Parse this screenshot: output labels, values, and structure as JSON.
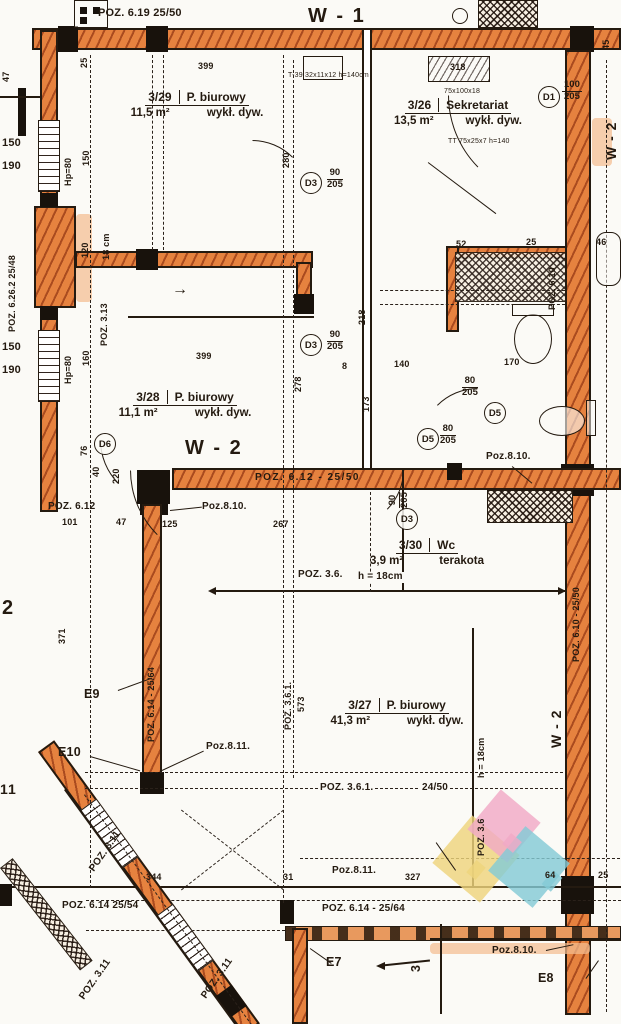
{
  "colors": {
    "wall_orange": "#e6823f",
    "wall_halo": "#f4bd90",
    "ink": "#241a10",
    "paper": "#fbfaf6",
    "logo_yellow": "#eed47c",
    "logo_pink": "#f0a9c6",
    "logo_teal": "#84cbd5"
  },
  "axes": {
    "w1": "W - 1",
    "w2_top_right": "W - 2",
    "w2_center": "W - 2",
    "w2_bottom_right": "W - 2",
    "axis_2": "2",
    "axis_11": "11",
    "section_3": "3"
  },
  "rooms": {
    "r329": {
      "num": "3/29",
      "name": "P. biurowy",
      "area": "11,5 m²",
      "finish": "wykł. dyw."
    },
    "r326": {
      "num": "3/26",
      "name": "Sekretariat",
      "area": "13,5 m²",
      "finish": "wykł. dyw."
    },
    "r328": {
      "num": "3/28",
      "name": "P. biurowy",
      "area": "11,1 m²",
      "finish": "wykł. dyw."
    },
    "r330": {
      "num": "3/30",
      "name": "Wc",
      "area": "3,9 m²",
      "finish": "terakota"
    },
    "r327": {
      "num": "3/27",
      "name": "P. biurowy",
      "area": "41,3 m²",
      "finish": "wykł. dyw."
    }
  },
  "poz": {
    "p619": "POZ. 6.19 25/50",
    "p6262": "POZ. 6.26.2 25/48",
    "p313": "POZ. 3.13",
    "p612_wall": "POZ. 6.12 - 25/50",
    "p612": "POZ. 6.12",
    "p810_a": "Poz.8.10.",
    "p810_b": "Poz.8.10.",
    "p810_c": "Poz.8.10.",
    "p811_a": "Poz.8.11.",
    "p811_b": "Poz.8.11.",
    "p36": "POZ. 3.6.",
    "p36_axis": "POZ. 3.6",
    "p361_v": "POZ. 3.6.1.",
    "p361": "POZ. 3.6.1.",
    "p361_size": "24/50",
    "p311_a": "POZ. 3.11",
    "p311_b": "POZ. 3.11",
    "p311_c": "POZ. 3.11",
    "p614_left": "POZ. 6.14 25/54",
    "p614_bottom": "POZ. 6.14 - 25/64",
    "p614_wall": "POZ. 6.14 - 25/64",
    "p610_top": "POZ. 6.10",
    "p610_right": "POZ. 6.10 - 25/50"
  },
  "exits": {
    "e7": "E7",
    "e8": "E8",
    "e9": "E9",
    "e10": "E10"
  },
  "doors": {
    "d1": {
      "tag": "D1",
      "w": "100",
      "h": "205"
    },
    "d3a": {
      "tag": "D3",
      "w": "90",
      "h": "205"
    },
    "d3b": {
      "tag": "D3",
      "w": "90",
      "h": "205"
    },
    "d3c": {
      "tag": "D3",
      "w": "90",
      "h": "205"
    },
    "d5a": {
      "tag": "D5",
      "w": "80",
      "h": "205"
    },
    "d5b": {
      "tag": "D5",
      "w": "80",
      "h": "205"
    },
    "d6": {
      "tag": "D6"
    }
  },
  "dims": {
    "v399a": "399",
    "v399b": "399",
    "v318": "318",
    "v280": "280",
    "v218": "218",
    "v278": "278",
    "v8": "8",
    "v140": "140",
    "v170": "170",
    "v120": "120",
    "v18cm": "18 cm",
    "v173": "173",
    "v101": "101",
    "v47": "47",
    "v47b": "47",
    "v125": "125",
    "v267": "267",
    "v371": "371",
    "v344": "344",
    "v31": "31",
    "v327": "327",
    "v64": "64",
    "v25a": "25",
    "v25b": "25",
    "v25c": "25",
    "v45": "45",
    "v52": "52",
    "v46": "46",
    "v573": "573",
    "v150a": "150",
    "v190a": "190",
    "v150r": "150",
    "v150b": "150",
    "v190b": "190",
    "v160": "160",
    "vhp80a": "Hp=80",
    "vhp80b": "Hp=80",
    "v220": "220",
    "v76": "76",
    "v40": "40",
    "vh18": "h = 18cm",
    "vh18b": "h = 18cm"
  },
  "notes": {
    "t39": "T-39 32x11x12 h=140cm",
    "rad": "75x100x18",
    "tt": "TT 75x25x7 h=140",
    "arrow": "→"
  }
}
